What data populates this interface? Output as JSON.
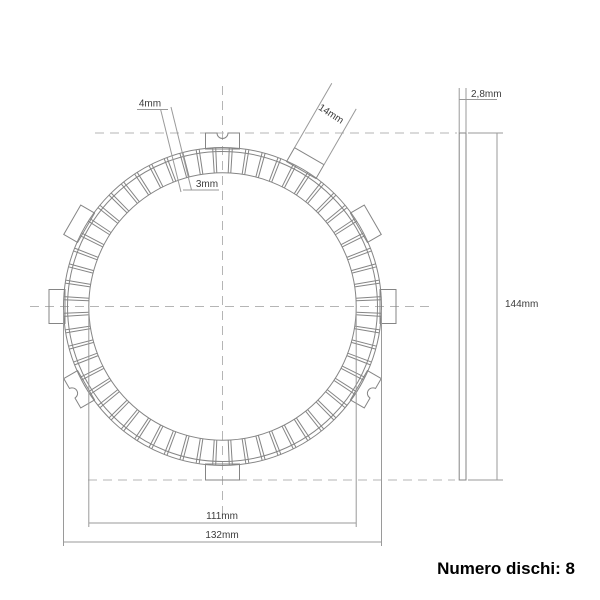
{
  "drawing": {
    "type": "clutch-friction-disc-technical-drawing",
    "dimension_labels": {
      "groove_width_outer": "4mm",
      "groove_width_inner": "3mm",
      "tab_width": "14mm",
      "thickness": "2,8mm",
      "friction_inner_diameter": "111mm",
      "friction_outer_diameter": "132mm",
      "overall_diameter": "144mm"
    },
    "footer_label": "Numero dischi: 8",
    "geometry": {
      "center": {
        "x": 222.5,
        "y": 306.5
      },
      "plate_outer_radius": 159,
      "pad_outer_radius": 155,
      "pad_inner_radius": 133.7,
      "groove_count": 60,
      "groove_start_angle_deg": 3,
      "groove_step_deg": 6,
      "groove_half_angle_deg": 0.55,
      "tab_base_radius": 157.5,
      "tab_tip_radius": 173.5,
      "tab_half_width": 17,
      "tab_angles_deg": [
        0,
        30,
        60,
        90,
        150,
        180,
        210,
        270,
        330
      ],
      "notched_tab_angles_deg": [
        90,
        210,
        330
      ],
      "notch_radius": 5.5,
      "side_view": {
        "x": 459.2,
        "y": 133,
        "width": 6.8,
        "height": 347
      }
    },
    "colors": {
      "outline": "#858585",
      "dimension": "#9a9a9a",
      "centerline": "#b5b5b5",
      "label_text": "#3c3c3c",
      "footer_text": "#000000"
    }
  }
}
